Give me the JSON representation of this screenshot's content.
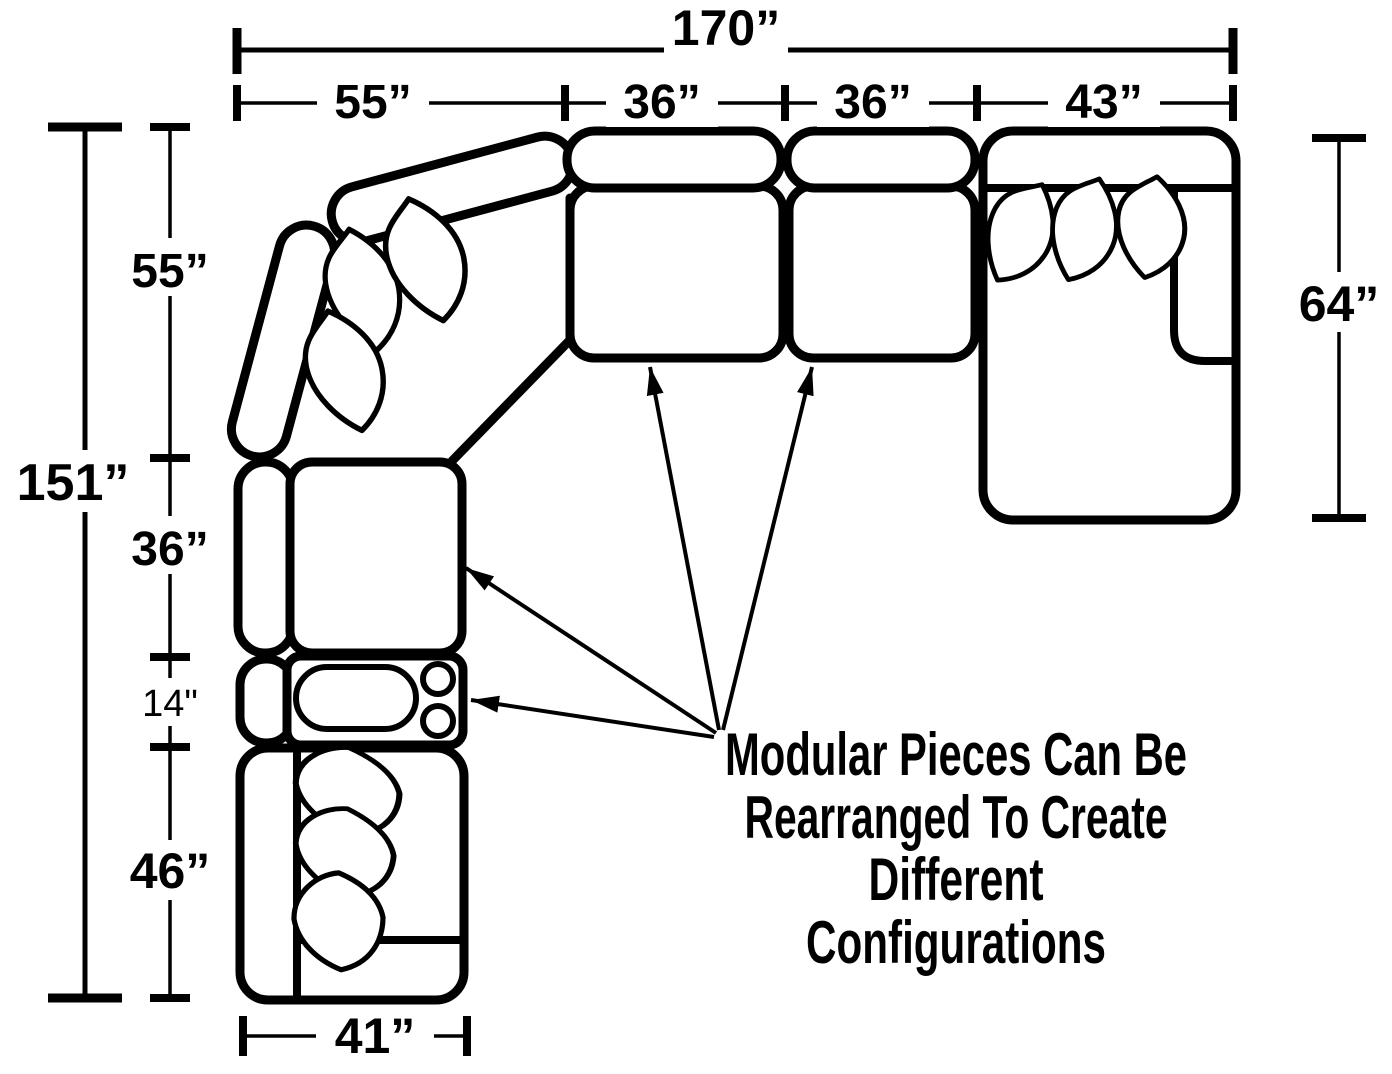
{
  "colors": {
    "ink": "#000000",
    "paper": "#ffffff"
  },
  "figure": {
    "note": {
      "lines": [
        "Modular Pieces Can Be",
        "Rearranged To Create",
        "Different",
        "Configurations"
      ]
    },
    "dims": {
      "width_total": "170”",
      "width_segments": [
        "55”",
        "36”",
        "36”",
        "43”"
      ],
      "height_total": "151”",
      "height_segments": [
        "55”",
        "36”",
        "14\"",
        "46”"
      ],
      "chaise_length": "64”",
      "bottom_piece_width": "41”"
    }
  }
}
